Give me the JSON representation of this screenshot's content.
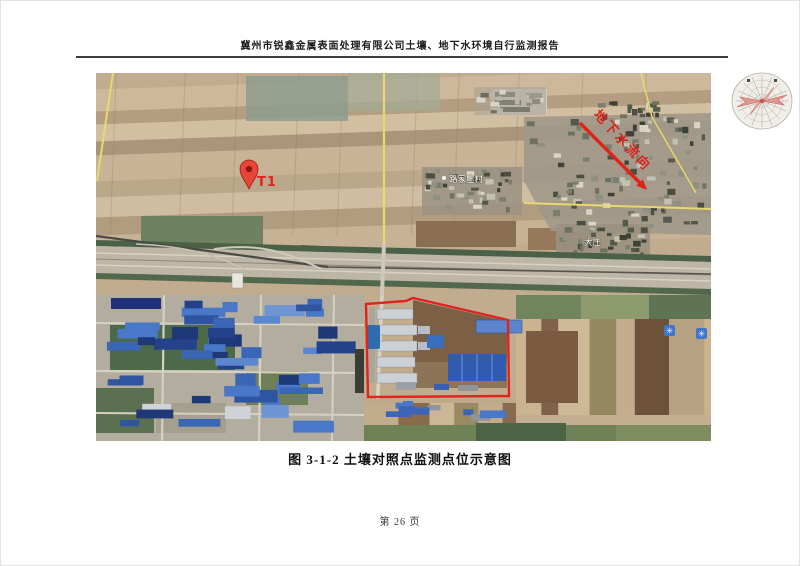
{
  "page": {
    "header_title": "冀州市锐鑫金属表面处理有限公司土壤、地下水环境自行监测报告",
    "figure_caption": "图 3-1-2 土壤对照点监测点位示意图",
    "page_number": "第 26 页"
  },
  "map": {
    "marker_label": "T1",
    "groundwater_flow_label": "地下水流向",
    "village_labels": [
      "路家庄村",
      "大庄"
    ],
    "poi_glyph": "✳",
    "colors": {
      "annotation_red": "#e0231c",
      "pin_red": "#e8453a",
      "roof_blue": "#3a66b5",
      "road_yellow": "#e8d86e"
    }
  }
}
